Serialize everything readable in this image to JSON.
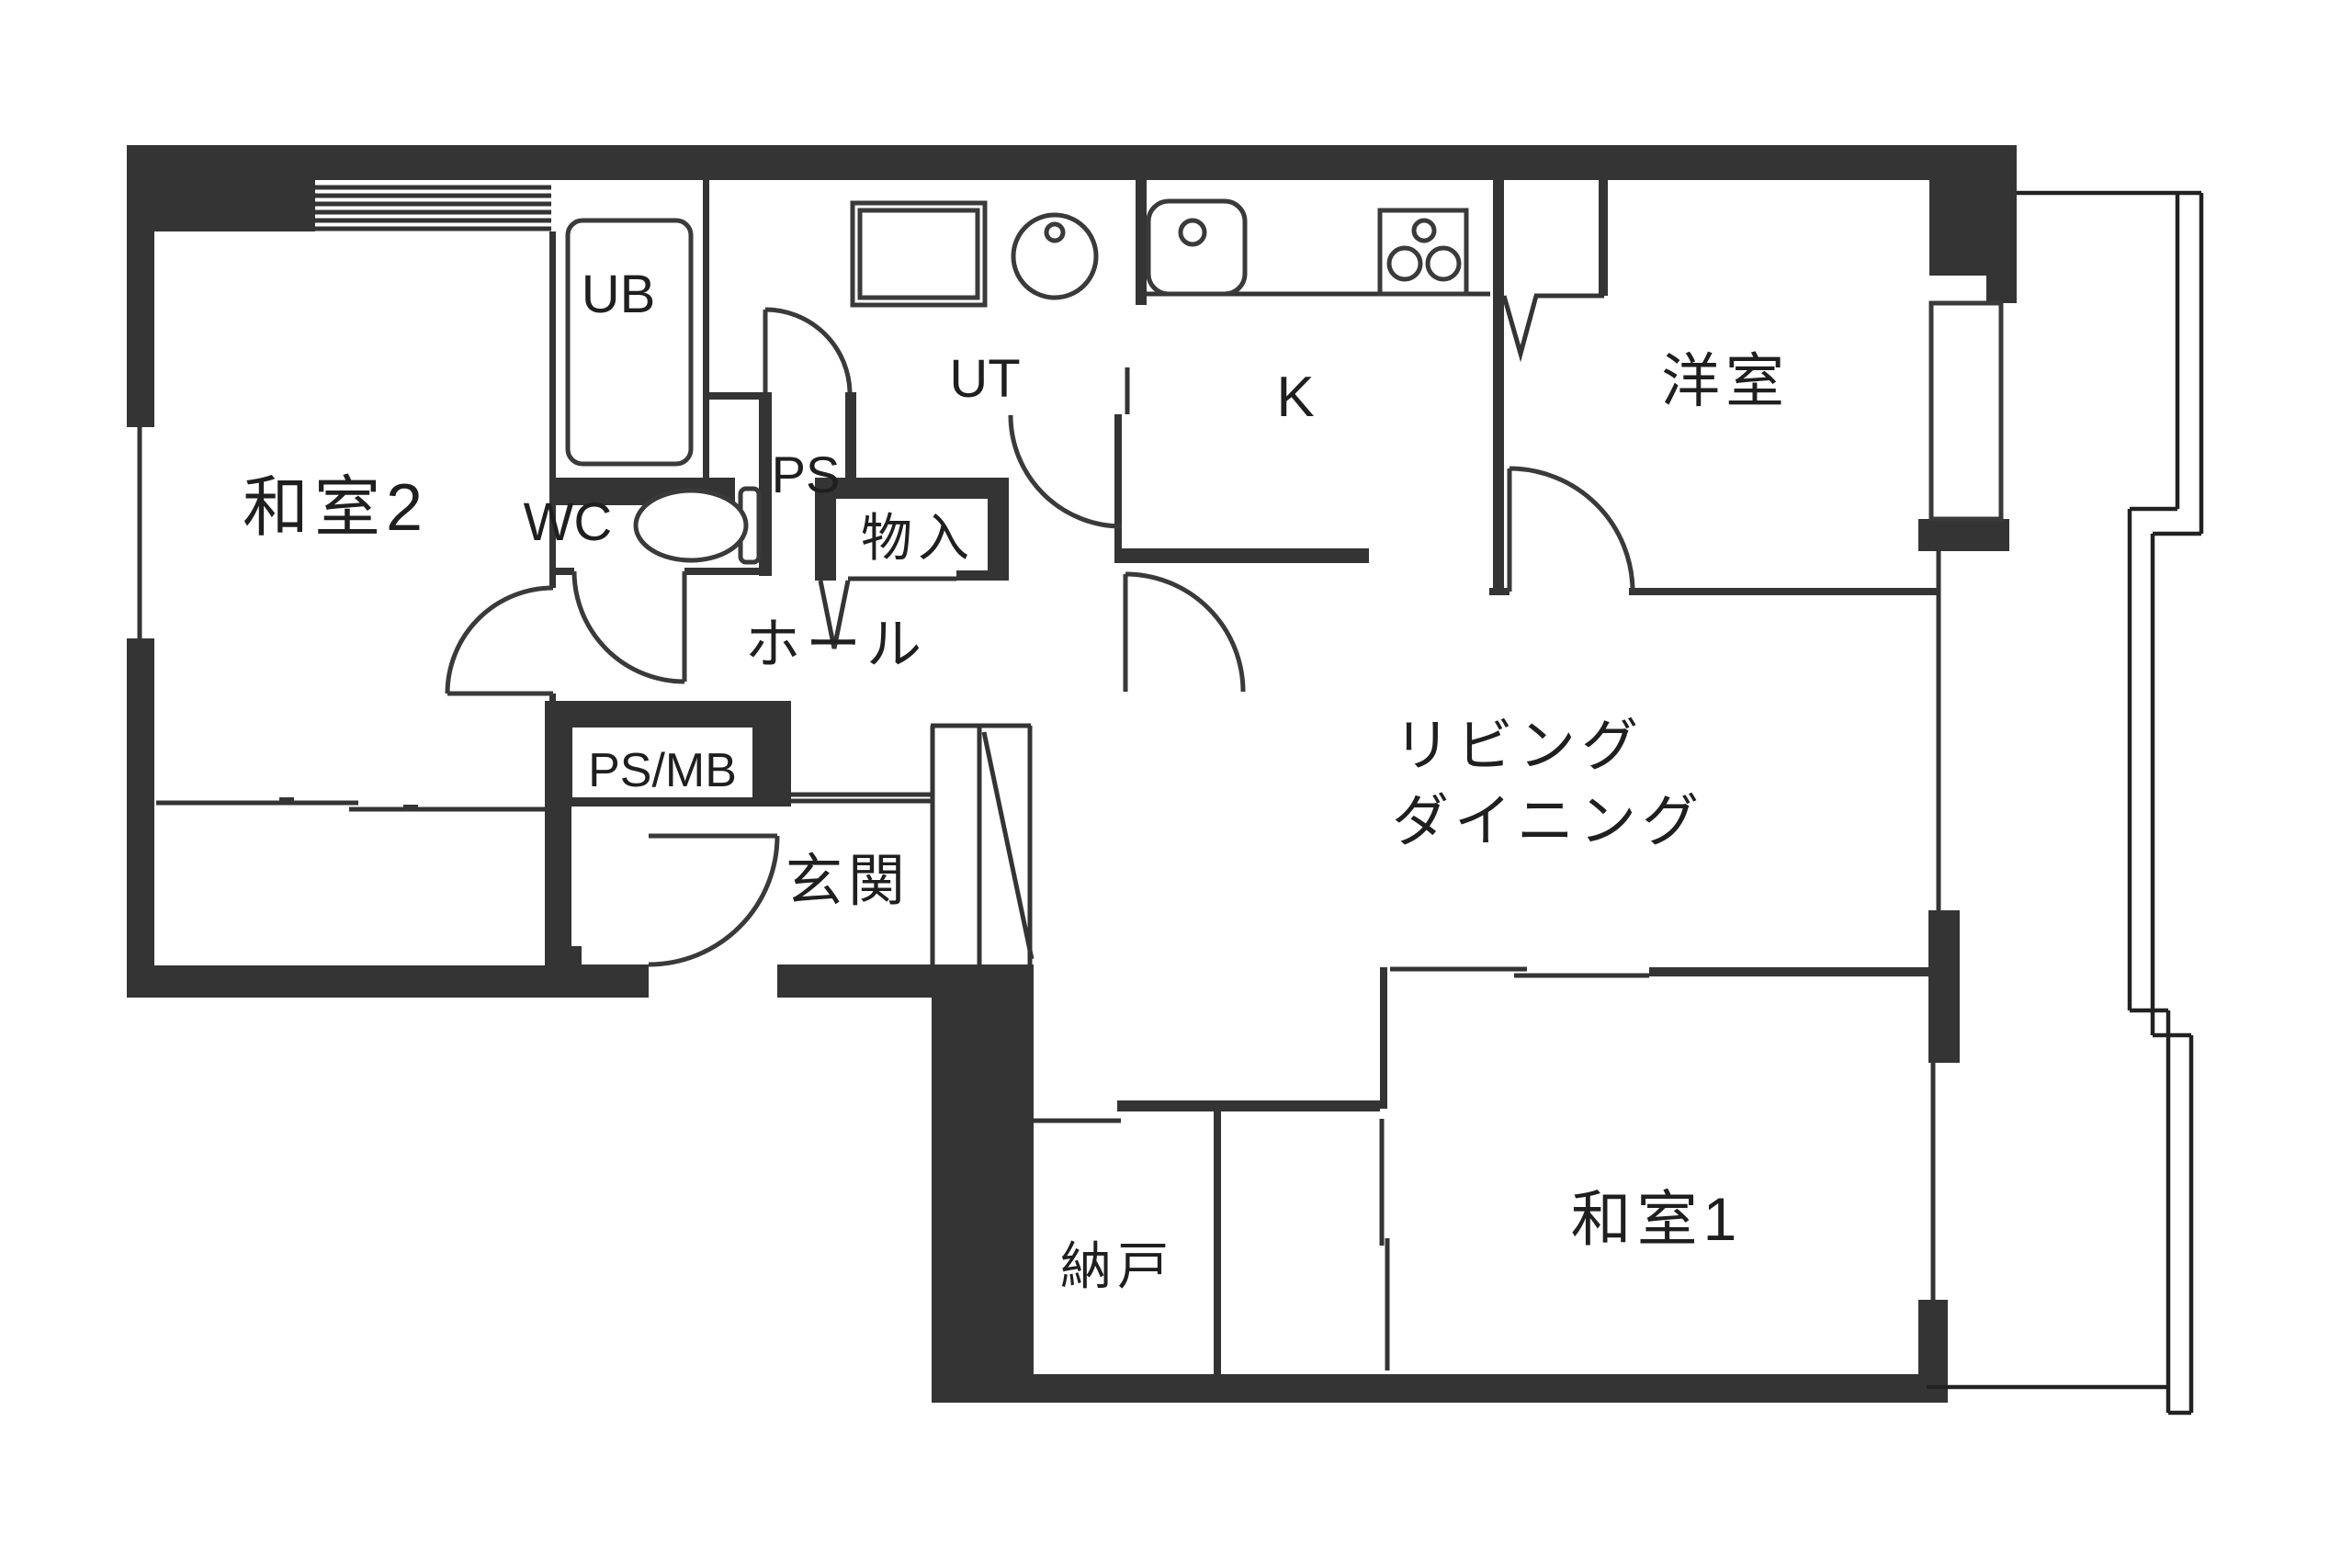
{
  "plan": {
    "type": "apartment-floor-plan",
    "colors": {
      "wall": "#343434",
      "line": "#333333",
      "text": "#1f1f1f",
      "background": "#ffffff"
    },
    "rooms": [
      {
        "id": "washitsu2",
        "label": "和室2"
      },
      {
        "id": "ub",
        "label": "UB"
      },
      {
        "id": "wc",
        "label": "WC"
      },
      {
        "id": "ps",
        "label": "PS"
      },
      {
        "id": "monoire",
        "label": "物入"
      },
      {
        "id": "ut",
        "label": "UT"
      },
      {
        "id": "hall",
        "label": "ホール"
      },
      {
        "id": "psmb",
        "label": "PS/MB"
      },
      {
        "id": "genkan",
        "label": "玄関"
      },
      {
        "id": "kitchen",
        "label": "K"
      },
      {
        "id": "youshitsu",
        "label": "洋室"
      },
      {
        "id": "living",
        "label": "リビング"
      },
      {
        "id": "dining",
        "label": "ダイニング"
      },
      {
        "id": "nando",
        "label": "納戸"
      },
      {
        "id": "washitsu1",
        "label": "和室1"
      }
    ]
  }
}
